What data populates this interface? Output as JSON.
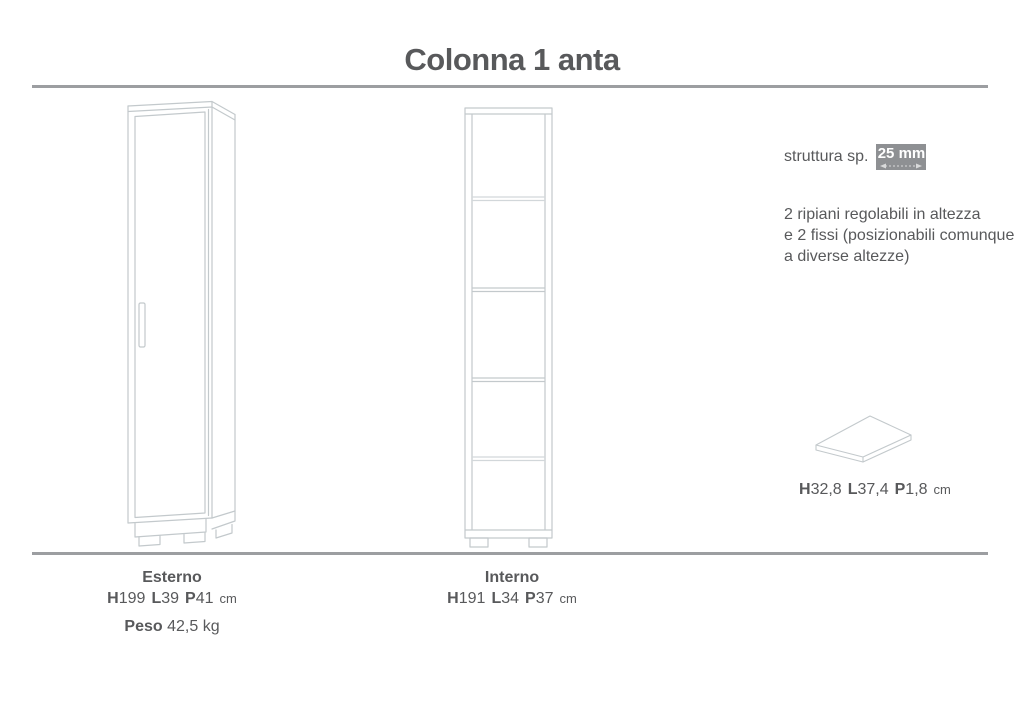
{
  "page": {
    "title": "Colonna 1 anta"
  },
  "colors": {
    "text": "#58595b",
    "rule": "#9c9ea1",
    "drawing": "#c3c9cc",
    "badge_bg": "#8e9093",
    "badge_text": "#ffffff"
  },
  "right_panel": {
    "thickness_label": "struttura sp.",
    "thickness_value": "25 mm",
    "shelves_note": [
      "2 ripiani regolabili in altezza",
      "e 2 fissi (posizionabili comunque",
      "a diverse altezze)"
    ],
    "shelf_panel": {
      "h_label": "H",
      "h_value": "32,8",
      "l_label": "L",
      "l_value": "37,4",
      "p_label": "P",
      "p_value": "1,8",
      "unit": "cm"
    }
  },
  "specs": {
    "esterno": {
      "label": "Esterno",
      "h_label": "H",
      "h_value": "199",
      "l_label": "L",
      "l_value": "39",
      "p_label": "P",
      "p_value": "41",
      "unit": "cm",
      "peso_label": "Peso",
      "peso_value": "42,5 kg"
    },
    "interno": {
      "label": "Interno",
      "h_label": "H",
      "h_value": "191",
      "l_label": "L",
      "l_value": "34",
      "p_label": "P",
      "p_value": "37",
      "unit": "cm"
    }
  }
}
